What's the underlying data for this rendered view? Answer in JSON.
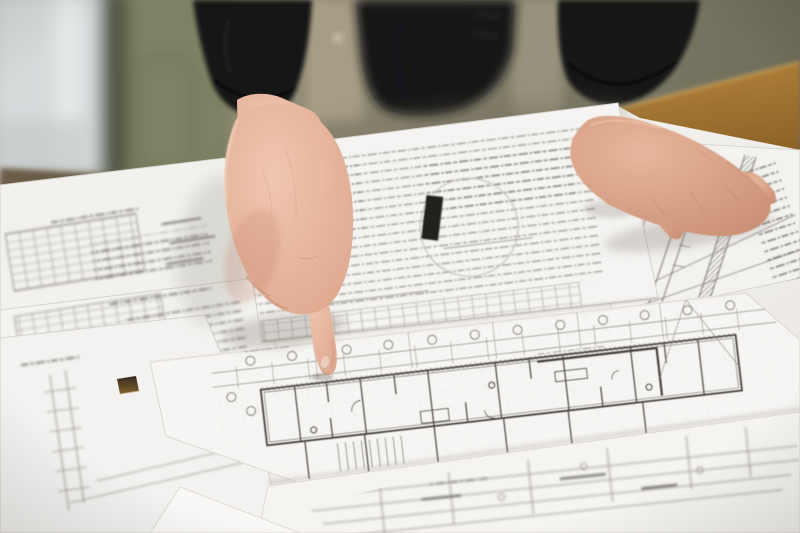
{
  "scene": {
    "description": "Photograph: an architect in a dark jacket stands at a wooden table, left index finger pointing down onto a large architectural floor-plan blueprint; the right hand rests on overlapping drawing sheets; a bright window and olive wall are blurred in the background",
    "objects": {
      "window": "bright window with olive frame, upper left",
      "wall": "olive green wall",
      "table": "warm brown wooden table",
      "person": "torso in dark jacket, two arms",
      "pointing_hand": "left fist with extended index finger touching floor plan",
      "resting_hand": "right hand resting flat on drawings",
      "blueprints": "overlapping white sheets: floor plan with column grid bubbles, schedule tables, section drawings, dense notes",
      "punch_hole": "small punched hole in sheet showing table below",
      "ruler": "yellow wooden scale ruler under right palm"
    }
  },
  "colors": {
    "window_glass": "#d6dadb",
    "window_frame": "#4f5442",
    "door_panel": "#7e8164",
    "wall_light": "#a59c85",
    "wall_dark": "#6e6d5b",
    "sill": "#6b5c47",
    "wood_light": "#b9873e",
    "wood_dark": "#8a6126",
    "jacket": "#141417",
    "skin_light": "#f0c6b0",
    "skin_mid": "#dda68c",
    "skin_shadow": "#c98e74",
    "paper_bright": "#f7f6f4",
    "paper_dim": "#eae7e2",
    "ink_light": "#8a867f",
    "ink_dark": "#45413c",
    "ruler_yellow": "#c49a36",
    "hole_dark": "#32281c",
    "hole_light": "#86622f"
  }
}
